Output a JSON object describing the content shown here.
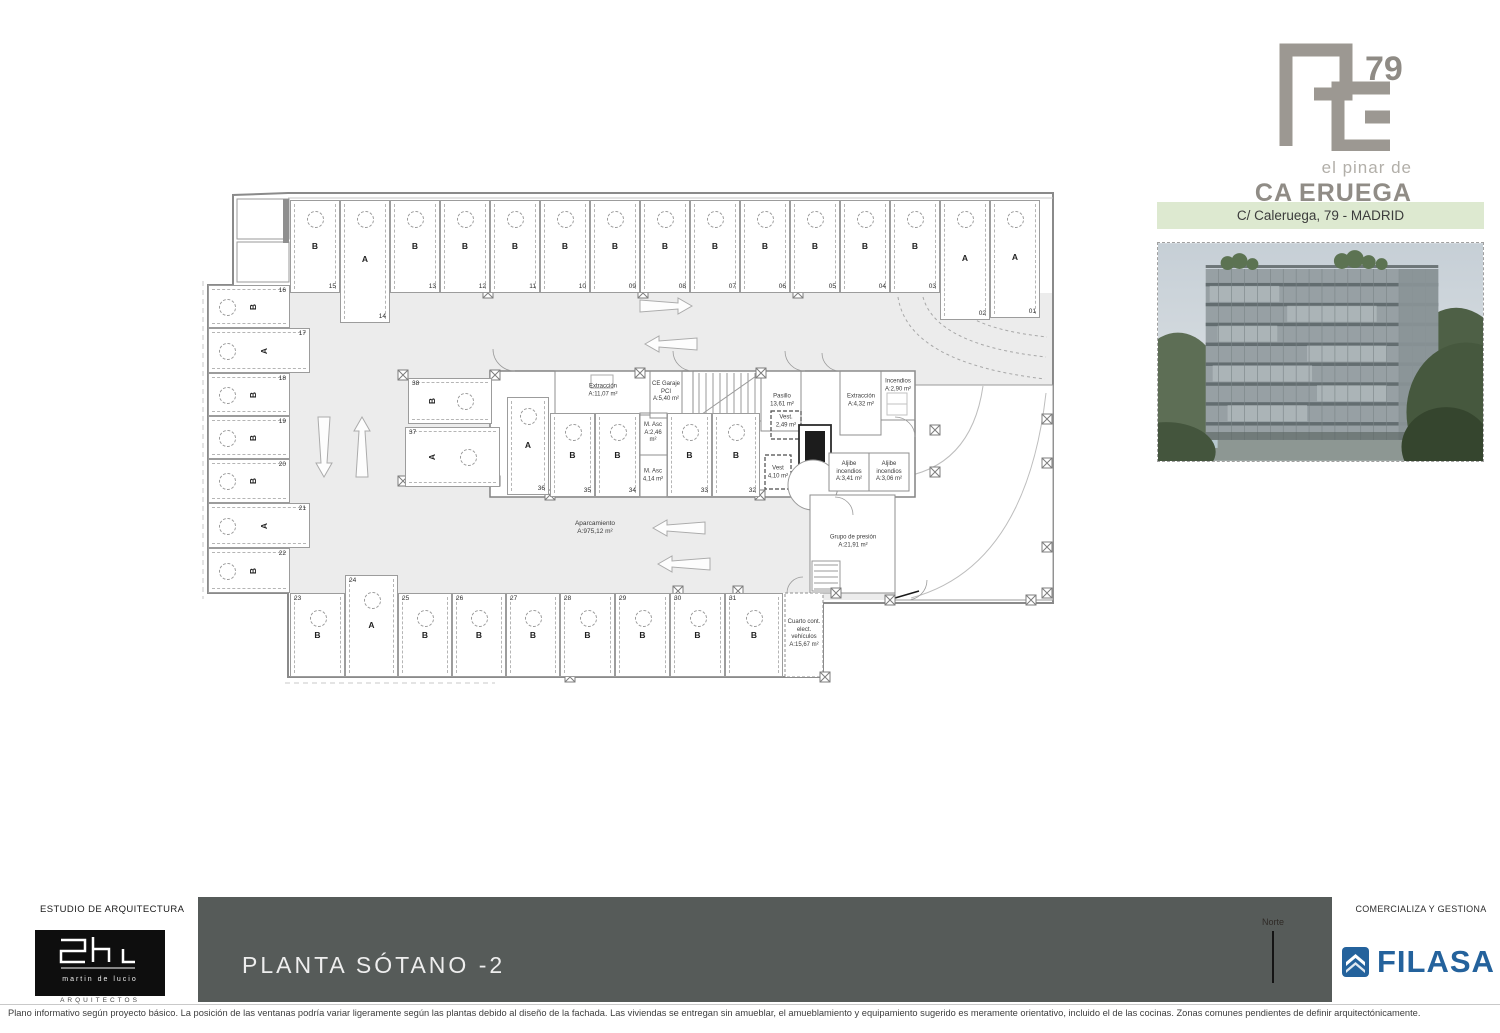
{
  "branding": {
    "logo_number": "79",
    "tagline": "el pinar de",
    "wordmark_left": "CA",
    "wordmark_right": "ERUEGA",
    "address_band": "C/ Caleruega, 79 - MADRID"
  },
  "plan": {
    "parking_label": "Aparcamiento",
    "parking_area": "A:975,12 m²",
    "spaces": [
      {
        "n": "01",
        "t": "A"
      },
      {
        "n": "02",
        "t": "A"
      },
      {
        "n": "03",
        "t": "B"
      },
      {
        "n": "04",
        "t": "B"
      },
      {
        "n": "05",
        "t": "B"
      },
      {
        "n": "06",
        "t": "B"
      },
      {
        "n": "07",
        "t": "B"
      },
      {
        "n": "08",
        "t": "B"
      },
      {
        "n": "09",
        "t": "B"
      },
      {
        "n": "10",
        "t": "B"
      },
      {
        "n": "11",
        "t": "B"
      },
      {
        "n": "12",
        "t": "B"
      },
      {
        "n": "13",
        "t": "B"
      },
      {
        "n": "14",
        "t": "A"
      },
      {
        "n": "15",
        "t": "B"
      },
      {
        "n": "16",
        "t": "B"
      },
      {
        "n": "17",
        "t": "A"
      },
      {
        "n": "18",
        "t": "B"
      },
      {
        "n": "19",
        "t": "B"
      },
      {
        "n": "20",
        "t": "B"
      },
      {
        "n": "21",
        "t": "A"
      },
      {
        "n": "22",
        "t": "B"
      },
      {
        "n": "23",
        "t": "B"
      },
      {
        "n": "24",
        "t": "A"
      },
      {
        "n": "25",
        "t": "B"
      },
      {
        "n": "26",
        "t": "B"
      },
      {
        "n": "27",
        "t": "B"
      },
      {
        "n": "28",
        "t": "B"
      },
      {
        "n": "29",
        "t": "B"
      },
      {
        "n": "30",
        "t": "B"
      },
      {
        "n": "31",
        "t": "B"
      },
      {
        "n": "32",
        "t": "B"
      },
      {
        "n": "33",
        "t": "B"
      },
      {
        "n": "34",
        "t": "B"
      },
      {
        "n": "35",
        "t": "B"
      },
      {
        "n": "36",
        "t": "A"
      },
      {
        "n": "37",
        "t": "A"
      },
      {
        "n": "38",
        "t": "B"
      }
    ],
    "rooms": [
      {
        "id": "extraccion1",
        "name": "Extracción",
        "area": "A:11,07 m²"
      },
      {
        "id": "ce_garaje",
        "name": "CE Garaje PCI",
        "area": "A:5,40 m²"
      },
      {
        "id": "pasillo",
        "name": "Pasillo",
        "area": "13,61 m²"
      },
      {
        "id": "vest1",
        "name": "Vest.",
        "area": "2,49 m²"
      },
      {
        "id": "m_asc1",
        "name": "M. Asc",
        "area": "A:2,46 m²"
      },
      {
        "id": "m_asc2",
        "name": "M. Asc",
        "area": "4,14 m²"
      },
      {
        "id": "vest2",
        "name": "Vest",
        "area": "4,10 m²"
      },
      {
        "id": "extraccion2",
        "name": "Extracción",
        "area": "A:4,32 m²"
      },
      {
        "id": "incendios",
        "name": "Incendios",
        "area": "A:2,90 m²"
      },
      {
        "id": "aljibe1",
        "name": "Aljibe incendios",
        "area": "A:3,41 m²"
      },
      {
        "id": "aljibe2",
        "name": "Aljibe incendios",
        "area": "A:3,06 m²"
      },
      {
        "id": "grupo_presion",
        "name": "Grupo de presión",
        "area": "A:21,91 m²"
      },
      {
        "id": "cuarto_vehiculos",
        "name": "Cuarto cont. elect. vehículos",
        "area": "A:15,67 m²"
      }
    ]
  },
  "footer": {
    "left_label": "ESTUDIO DE ARQUITECTURA",
    "architect_name": "martin de lucio",
    "architect_sub": "ARQUITECTOS",
    "title": "PLANTA SÓTANO -2",
    "north_label": "Norte",
    "right_label": "COMERCIALIZA Y GESTIONA",
    "brand_name": "FILASA",
    "disclaimer": "Plano informativo según proyecto básico. La posición de las ventanas podría variar ligeramente según las plantas debido al diseño de la fachada. Las viviendas se entregan sin amueblar, el amueblamiento y equipamiento sugerido es meramente orientativo, incluido el de las cocinas. Zonas comunes pendientes de definir arquitectónicamente."
  },
  "colors": {
    "address_band_bg": "#dde9d0",
    "title_bar_bg": "#565b59",
    "filasa_blue": "#24629c",
    "logo_gray": "#9c9892",
    "aisle_gray": "#ececec"
  }
}
